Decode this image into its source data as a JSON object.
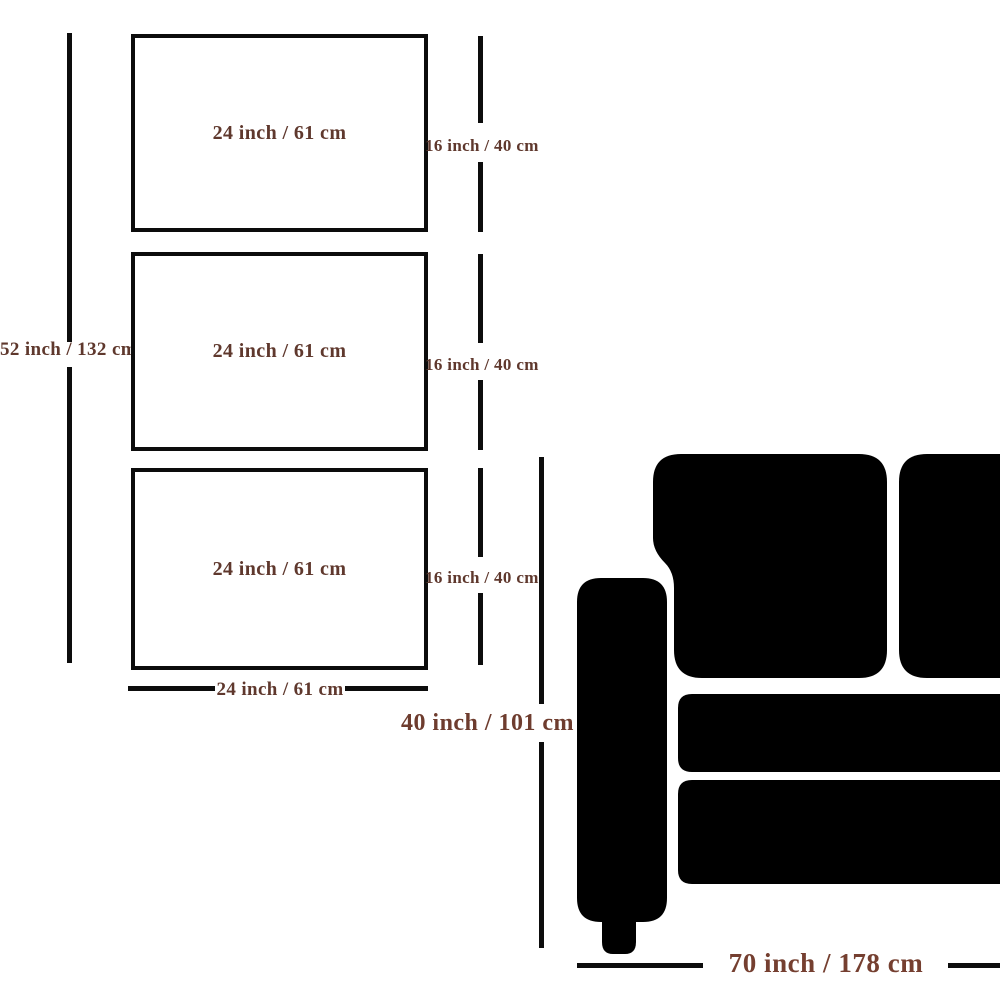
{
  "frames": [
    {
      "width_label": "24 inch / 61 cm",
      "height_label": "16 inch / 40 cm"
    },
    {
      "width_label": "24 inch / 61 cm",
      "height_label": "16 inch / 40 cm"
    },
    {
      "width_label": "24 inch / 61 cm",
      "height_label": "16 inch / 40 cm"
    }
  ],
  "overall": {
    "total_height_label": "52 inch / 132 cm",
    "bottom_width_label": "24 inch / 61 cm"
  },
  "sofa": {
    "height_label": "40 inch / 101 cm",
    "width_label": "70 inch / 178 cm"
  },
  "colors": {
    "label_brown": "#5f382d",
    "label_brown_large": "#753f30",
    "line_black": "#0d0d0d",
    "sofa_black": "#000000",
    "background": "#ffffff"
  }
}
